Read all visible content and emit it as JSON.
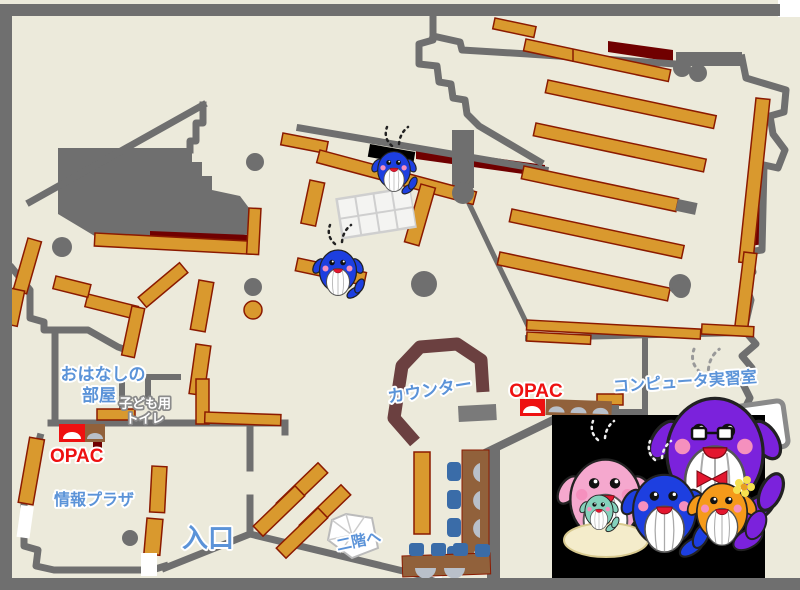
{
  "map": {
    "labels": {
      "storytelling_room": {
        "line1": "おはなしの",
        "line2": "部屋"
      },
      "kids_toilet": {
        "line1": "子ども用",
        "line2": "トイレ"
      },
      "opac_left": "OPAC",
      "info_plaza": "情報プラザ",
      "entrance": "入口",
      "to_second_floor": "二階へ",
      "counter": "カウンター",
      "opac_right": "OPAC",
      "computer_room": "コンピュータ実習室"
    }
  },
  "theme": {
    "floor": "#ECEADB",
    "wall": "#6F6F6F",
    "shelf": "#D9992E",
    "shelf_border": "#8B1A00",
    "dark_red": "#700000",
    "counter": "#6B4040",
    "desk": "#91613B",
    "chair": "#3A6CA8",
    "arch": "#B9C0CA",
    "label_blue": "#5B93D8",
    "label_red": "#EE1111",
    "grid_frame": "#CFCFCF",
    "grid_cell": "#F4F4F2",
    "whale_blue": "#1D3FE0",
    "whale_purple": "#7B22DC",
    "whale_pink": "#F5A8CE",
    "whale_orange": "#F59A1A",
    "whale_baby": "#85D2BC"
  }
}
